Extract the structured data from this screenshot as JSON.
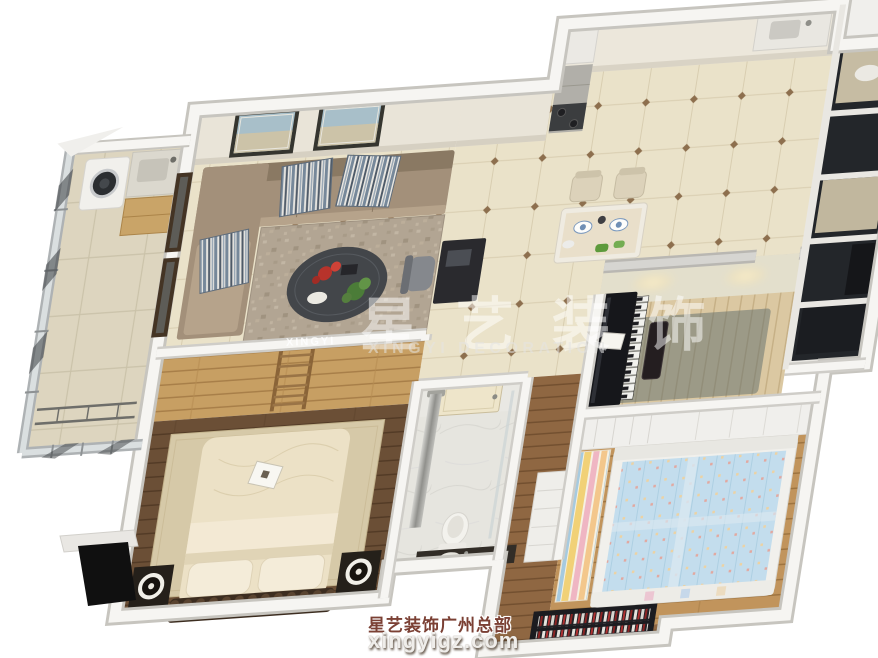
{
  "image_type": "3d-interior-floorplan-render",
  "watermark": {
    "brand_cn": "星艺装饰",
    "brand_en": "XINGYI DECORATION",
    "table_logo": "XINGYI",
    "footer_line1": "星艺装饰广州总部",
    "footer_line2": "xingyigz.com"
  },
  "colors": {
    "wm_text": "rgba(255,255,255,0.5)",
    "wm_sub": "rgba(228,228,226,0.55)",
    "footer_cn": "#7b4034",
    "footer_web": "#efedea",
    "background": "#ffffff",
    "wall_top": "#f6f5f2",
    "wall_gray_top": "#b9b7b2",
    "tile_floor": "#eae2c9",
    "wood_wardrobe": "#c79f63",
    "wood_floor_dark": "#6b4f36",
    "sofa_taupe": "#a3907a",
    "bed_cream": "#ece1c6",
    "piano_black": "#16171b",
    "kids_mattress_blue": "#c3dded",
    "kids_stripe_yellow": "#f1d177",
    "kids_stripe_pink": "#efb6c3",
    "glass_dark": "#23262a",
    "accent_flower_red": "#b7332b",
    "accent_plant_green": "#4b7c38"
  },
  "scene": {
    "view": "isometric dollhouse cutaway, walls cut at top",
    "rooms": [
      "laundry-balcony",
      "living-room",
      "hallway-dining",
      "kitchen",
      "service-window-wall",
      "piano-study-room",
      "master-bedroom",
      "bathroom",
      "entry-corridor",
      "kids-bedroom"
    ]
  }
}
